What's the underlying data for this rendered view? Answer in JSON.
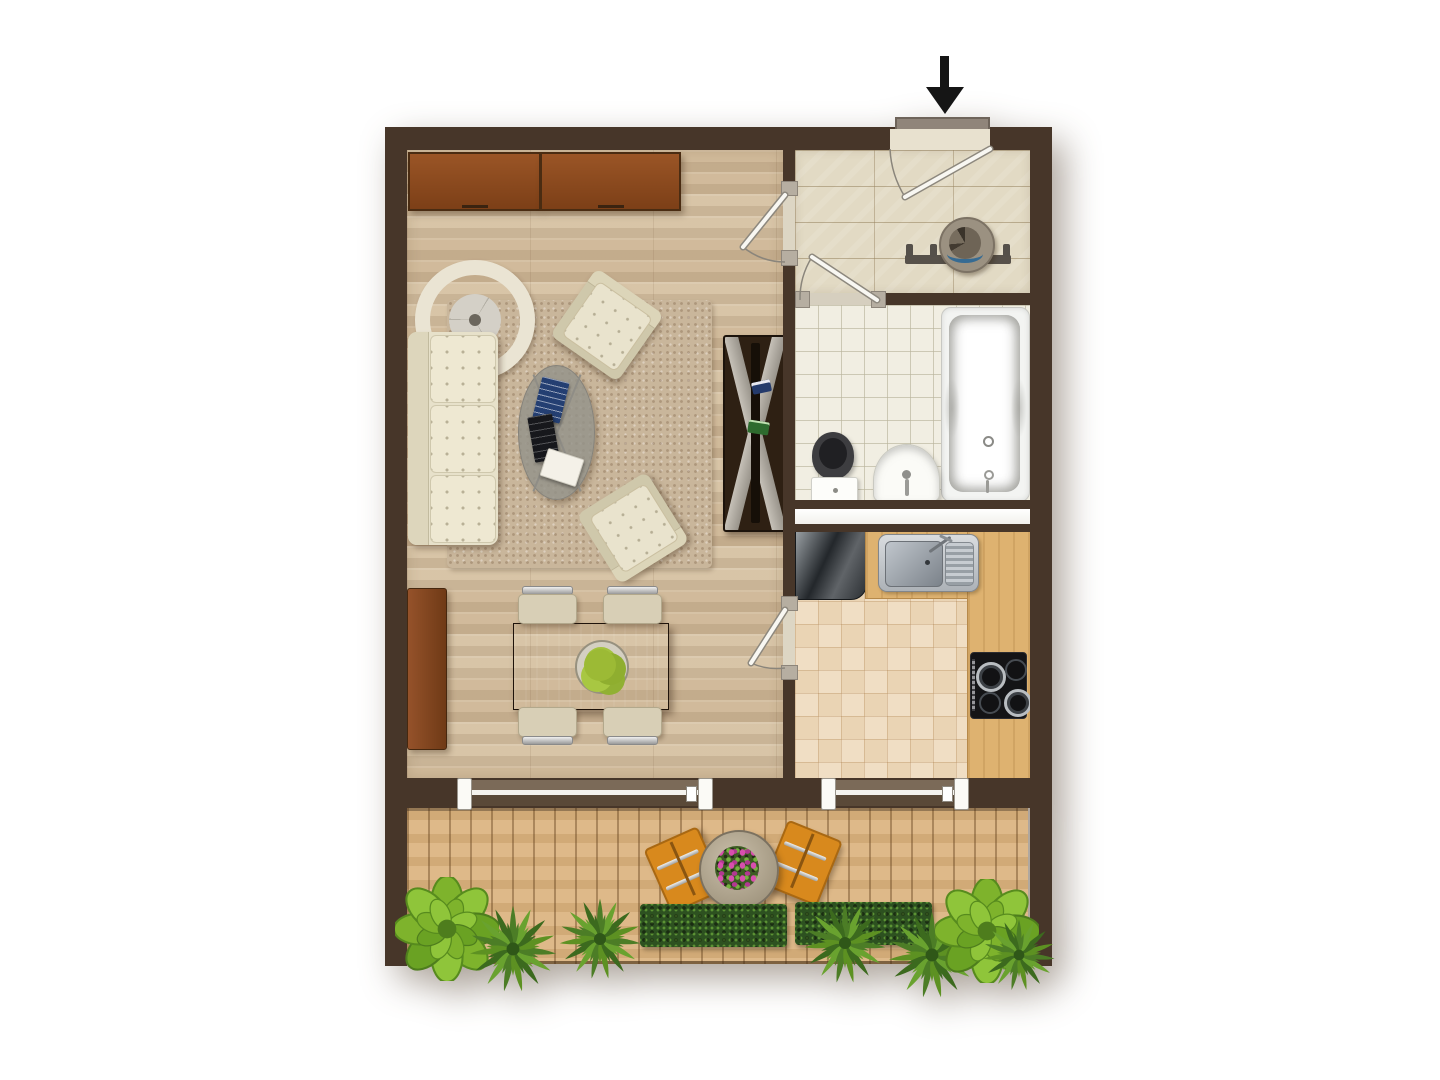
{
  "title": "one-room-apartment-floor-plan",
  "entrance": {
    "marker": "down-arrow"
  },
  "colors": {
    "wall": "#473629",
    "living_floor": "#d6c1a2",
    "hall_floor": "#e2dac4",
    "bath_floor": "#f1eee2",
    "kitchen_floor": "#eed9ba",
    "deck": "#dbb480",
    "counter": "#deb270",
    "rug": "#c9b69b",
    "cream": "#e7e1ca",
    "cabinet": "#8f4f23",
    "dark_wood": "#35231a",
    "orange": "#d8891d",
    "hedge": "#2d5120",
    "plant_bright": "#7eb32c",
    "plant_dark": "#54842a"
  },
  "rooms": [
    {
      "id": "living-room",
      "floor": "oak-plank"
    },
    {
      "id": "entrance-hall",
      "floor": "stone-tile"
    },
    {
      "id": "bathroom",
      "floor": "ceramic-tile"
    },
    {
      "id": "kitchen",
      "floor": "terracotta-tile"
    },
    {
      "id": "balcony",
      "floor": "wood-decking"
    }
  ],
  "furniture": {
    "living_room": [
      "sideboard",
      "sideboard",
      "wall-clock",
      "sofa",
      "rug",
      "coffee-table",
      "magazines",
      "armchair",
      "armchair",
      "tv-rack",
      "lowboard",
      "dining-table",
      "fruit-bowl",
      "chair",
      "chair",
      "chair",
      "chair"
    ],
    "entrance_hall": [
      "coat-rack",
      "hat"
    ],
    "bathroom": [
      "bathtub",
      "toilet",
      "wash-basin"
    ],
    "kitchen": [
      "refrigerator",
      "counter",
      "sink-unit",
      "cooktop"
    ],
    "balcony": [
      "round-table",
      "flower-pot",
      "deck-chair",
      "deck-chair",
      "hedge",
      "hedge",
      "plants"
    ]
  },
  "doors": [
    "entry-door",
    "living-room-door",
    "bathroom-door",
    "kitchen-door",
    "sliding-door",
    "sliding-door"
  ]
}
